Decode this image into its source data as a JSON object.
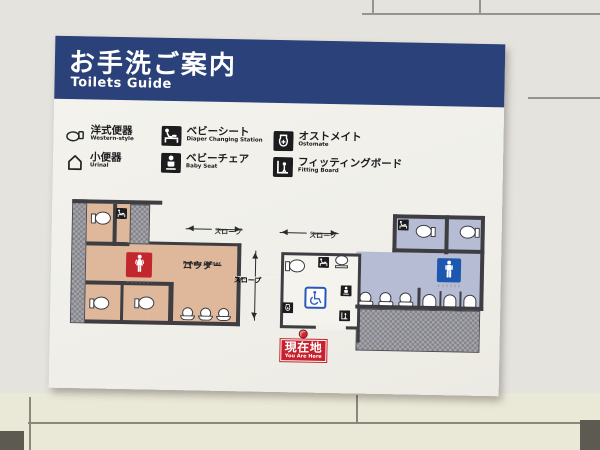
{
  "header": {
    "title_jp": "お手洗ご案内",
    "title_en": "Toilets Guide"
  },
  "legend": {
    "items": [
      {
        "jp": "洋式便器",
        "en": "Western-style",
        "icon": "western-toilet-icon"
      },
      {
        "jp": "小便器",
        "en": "Urinal",
        "icon": "urinal-icon"
      },
      {
        "jp": "ベビーシート",
        "en": "Diaper Changing Station",
        "icon": "diaper-changing-icon"
      },
      {
        "jp": "ベビーチェア",
        "en": "Baby Seat",
        "icon": "baby-seat-icon"
      },
      {
        "jp": "オストメイト",
        "en": "Ostomate",
        "icon": "ostomate-icon"
      },
      {
        "jp": "フィッティングボード",
        "en": "Fitting Board",
        "icon": "fitting-board-icon"
      }
    ]
  },
  "plan": {
    "labels": {
      "slope_jp": "スロープ",
      "slope_en": "Slope",
      "powder_line1": "パウダー",
      "powder_line2": "コーナー",
      "powder_en": "Powder Corner",
      "you_are_here_jp": "現在地",
      "you_are_here_en": "You Are Here"
    },
    "rooms": [
      {
        "name": "womens-toilet",
        "area_color": "#dfb89c",
        "sign_color": "#c3272e",
        "fixtures": [
          "toilet",
          "toilet",
          "toilet",
          "diaper-changing-icon",
          "powder-corner-mirrors",
          "stools"
        ]
      },
      {
        "name": "accessible-toilet",
        "area_color": "#f4f3ee",
        "sign_color": "#2a58b8",
        "fixtures": [
          "toilet",
          "washbasin",
          "diaper-changing-icon",
          "ostomate-icon",
          "baby-seat-icon",
          "fitting-board-icon",
          "wheelchair-sign"
        ]
      },
      {
        "name": "mens-toilet",
        "area_color": "#b6bcd4",
        "sign_color": "#1c57b0",
        "fixtures": [
          "toilet",
          "toilet",
          "diaper-changing-icon",
          "washbasin",
          "washbasin",
          "washbasin",
          "urinal",
          "urinal",
          "urinal"
        ]
      }
    ]
  },
  "colors": {
    "header_navy": "#2a4179",
    "sign_panel": "#f2f1ec",
    "womens_area_tan": "#dfb89c",
    "mens_area_blue": "#b6bcd4",
    "womens_sign_red": "#c3272e",
    "mens_sign_blue": "#1c57b0",
    "accessible_blue": "#2a58b8",
    "you_are_here_red": "#c5202c",
    "hatch_gray": "#83838a",
    "wall_line": "#3d3d42"
  }
}
